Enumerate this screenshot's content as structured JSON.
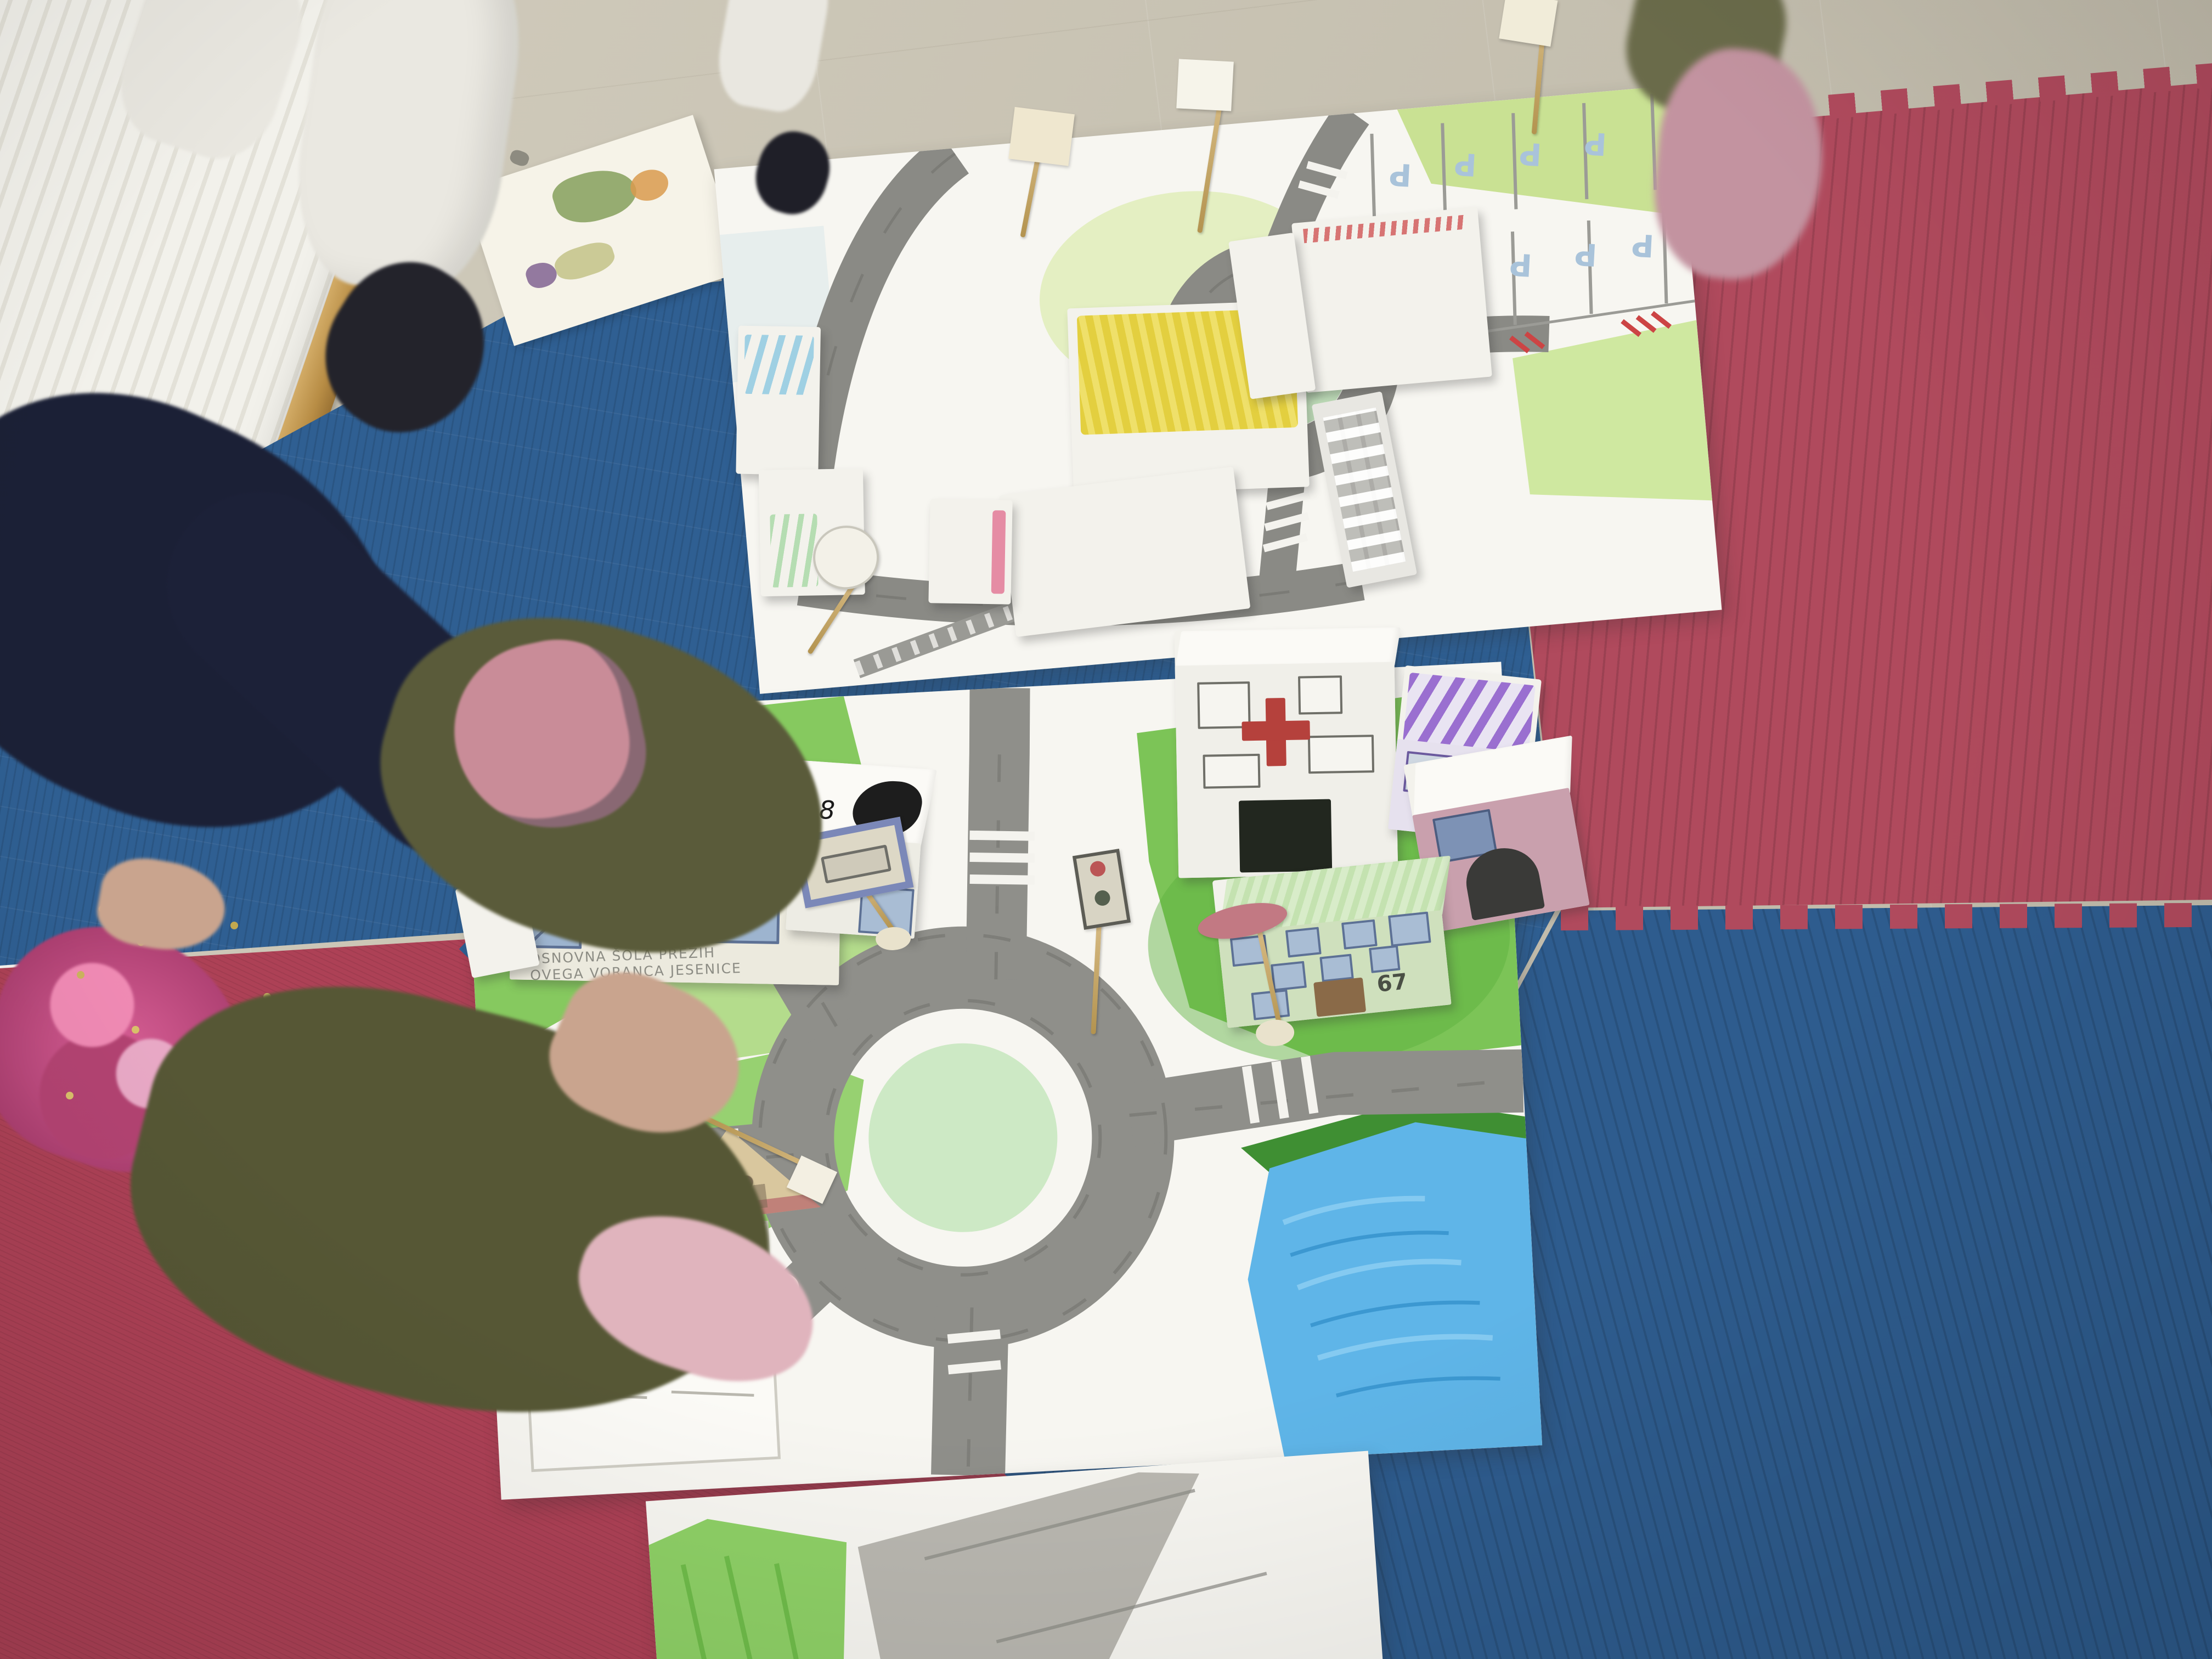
{
  "scene": {
    "description": "Classroom floor: children's hand-drawn paper city maps with paper-box buildings on red and blue foam puzzle mats; one child sitting at left, other children's feet at top",
    "colors": {
      "floor_tile": "#cdc7b6",
      "wall": "#efeee8",
      "baseboard": "#c09a58",
      "mat_blue": "#2f5f92",
      "mat_red": "#b04a5d",
      "poster_paper": "#f7f6f1",
      "road_pencil": "#8f8f8a",
      "grass_green": "#7cc457",
      "roundabout_green": "#cde9c5",
      "lake_blue": "#5fb5e8",
      "parking_letter_blue": "#a9c3da",
      "hospital_cross_red": "#b5413c",
      "sweater_navy": "#1b2036",
      "sequin_pink": "#d95f96",
      "pants_olive": "#5a5b3a",
      "shoe_pink": "#c98c98"
    }
  },
  "upper_map": {
    "parking_rows": [
      [
        "P",
        "P",
        "P",
        "P"
      ],
      [
        "P",
        "P",
        "P",
        "P",
        "P"
      ]
    ]
  },
  "lower_map": {
    "school_sign": {
      "line1": "OSNOVNA ŠOLA PREŽIH",
      "line2": "OVEGA VORANCA JESENICE"
    },
    "apartment_number": "67",
    "small_house_mark": "8"
  }
}
